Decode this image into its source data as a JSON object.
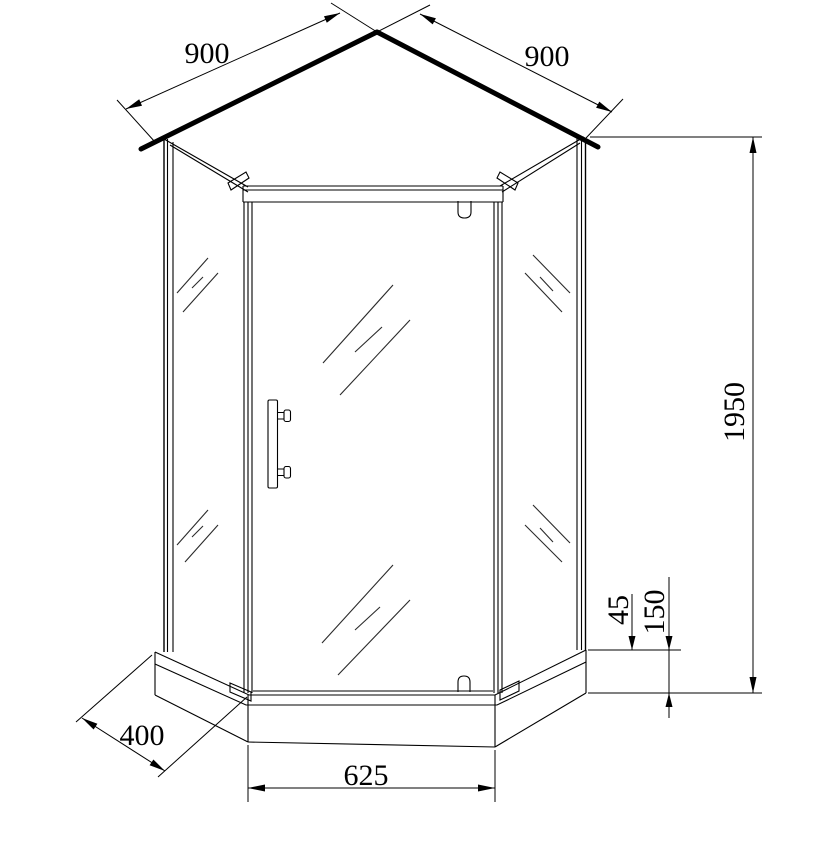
{
  "diagram": {
    "type": "technical-drawing",
    "subject": "pentagonal corner shower enclosure with tray",
    "background_color": "#ffffff",
    "line_color": "#000000",
    "dimensions": {
      "top_left_width": "900",
      "top_right_width": "900",
      "overall_height": "1950",
      "tray_lip_height": "45",
      "tray_height": "150",
      "side_depth": "400",
      "front_width": "625"
    }
  }
}
